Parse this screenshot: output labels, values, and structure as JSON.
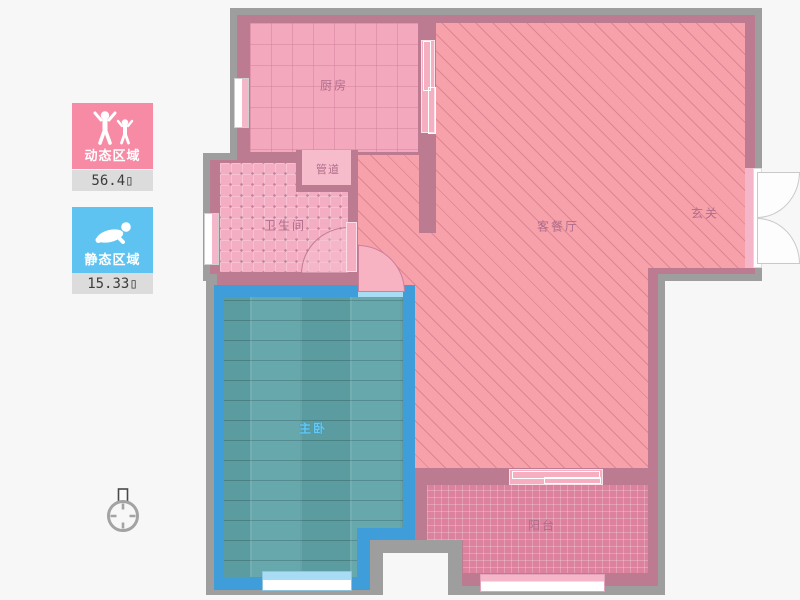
{
  "legend": {
    "dynamic": {
      "label": "动态区域",
      "value": "56.4▯",
      "icon": "figures-cheering-icon",
      "color": "#f78ba6"
    },
    "static": {
      "label": "静态区域",
      "value": "15.33▯",
      "icon": "person-lying-icon",
      "color": "#5ec3f0"
    }
  },
  "rooms": {
    "kitchen": {
      "label": "厨房"
    },
    "duct": {
      "label": "管道"
    },
    "bathroom": {
      "label": "卫生间"
    },
    "living": {
      "label": "客餐厅"
    },
    "entry": {
      "label": "玄关"
    },
    "bedroom": {
      "label": "主卧"
    },
    "balcony": {
      "label": "阳台"
    }
  },
  "colors": {
    "bg": "#f7f7f7",
    "wall-gray": "#9e9e9e",
    "wall-mauve": "#bd7b92",
    "wall-blue": "#3f9ed9",
    "kitchen-floor": "#f3a8bd",
    "bath-floor": "#f3aec3",
    "bath-dot": "#c9819f",
    "living-floor": "#f7a1ab",
    "bedroom-floor": "#5fa3a8",
    "balcony-floor": "#dc819e",
    "niche-pink": "#f6bccb",
    "door-pink": "#f6afc1",
    "arc-pink": "#f8b3c3",
    "win-pink": "#f5b6c9",
    "win-blue": "#a8dcf5",
    "legend-pink": "#f78ba6",
    "legend-blue": "#5ec3f0",
    "legend-bar": "#dcdcdc",
    "label-color": "#b06d8b",
    "bedroom-label": "#64c9f5"
  }
}
